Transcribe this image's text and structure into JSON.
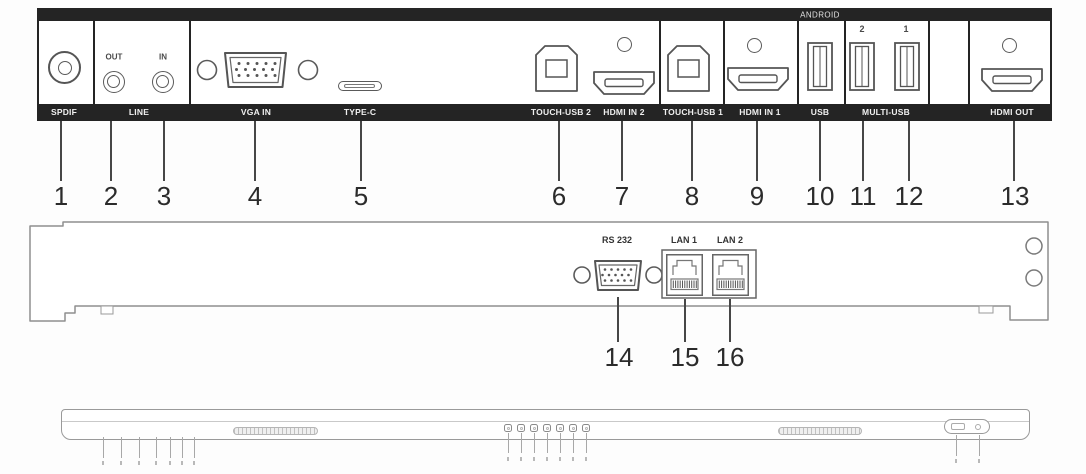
{
  "colors": {
    "panel_dark": "#242424",
    "line_art": "#5a5a5a",
    "callout_text": "#2b2b2b"
  },
  "top_panel": {
    "bar_label": "ANDROID",
    "jack_labels": {
      "out": "OUT",
      "in": "IN"
    },
    "usb_port_numbers": {
      "left": "2",
      "right": "1"
    },
    "strip_labels": {
      "spdif": "SPDIF",
      "line": "LINE",
      "vga_in": "VGA IN",
      "type_c": "TYPE-C",
      "touch_usb_2": "TOUCH-USB 2",
      "hdmi_in_2": "HDMI IN 2",
      "touch_usb_1": "TOUCH-USB 1",
      "hdmi_in_1": "HDMI IN 1",
      "usb": "USB",
      "multi_usb": "MULTI-USB",
      "hdmi_out": "HDMI OUT"
    },
    "callouts": {
      "c1": "1",
      "c2": "2",
      "c3": "3",
      "c4": "4",
      "c5": "5",
      "c6": "6",
      "c7": "7",
      "c8": "8",
      "c9": "9",
      "c10": "10",
      "c11": "11",
      "c12": "12",
      "c13": "13"
    }
  },
  "middle_panel": {
    "port_labels": {
      "rs232": "RS 232",
      "lan1": "LAN 1",
      "lan2": "LAN 2"
    },
    "callouts": {
      "c14": "14",
      "c15": "15",
      "c16": "16"
    }
  }
}
